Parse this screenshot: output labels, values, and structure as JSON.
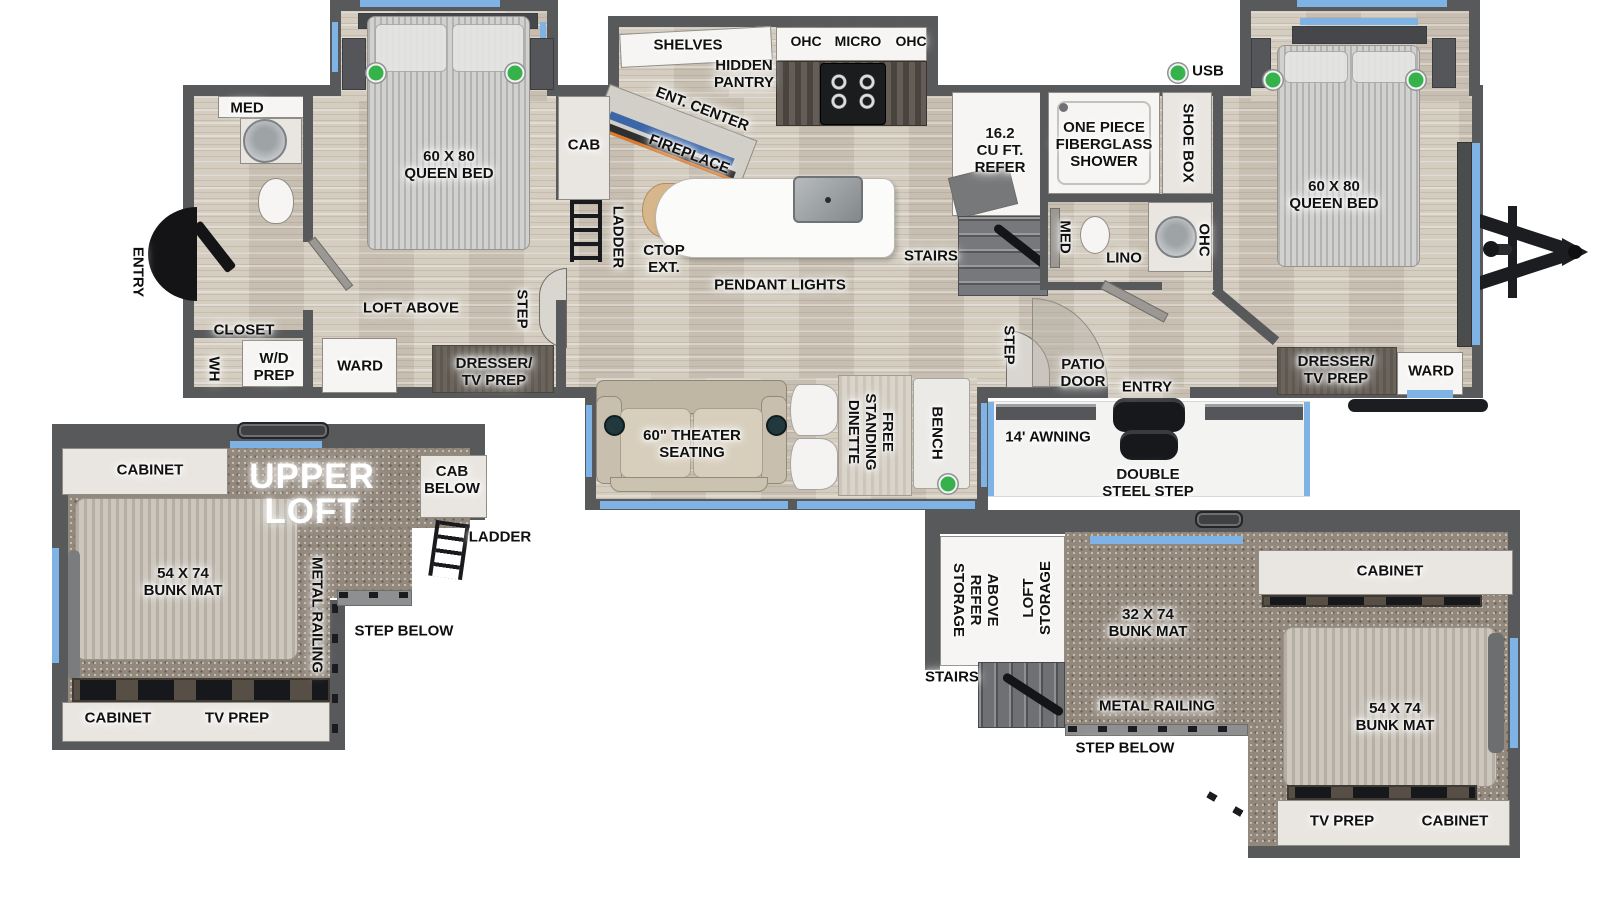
{
  "colors": {
    "wall": "#58595b",
    "floor_wood": "#cfc7b9",
    "carpet": "#93887c",
    "window_blue": "#7fb2e5",
    "usb_green": "#35b24a",
    "island_white": "#fbfbfa",
    "fireplace_orange": "#dd7a2c",
    "tv_blue": "#3b66a8",
    "steel_black": "#1c1d20"
  },
  "fp": {
    "main": {
      "rear": {
        "entry": "ENTRY",
        "med": "MED",
        "closet": "CLOSET",
        "wh": "WH",
        "wd": "W/D\nPREP"
      },
      "bed2": {
        "queen": "60 X 80\nQUEEN BED",
        "loft": "LOFT ABOVE",
        "ward": "WARD",
        "dresser": "DRESSER/\nTV PREP",
        "step": "STEP"
      },
      "kit": {
        "shelves": "SHELVES",
        "pantry": "HIDDEN\nPANTRY",
        "ent": "ENT. CENTER",
        "fire": "FIREPLACE",
        "cab": "CAB",
        "ladder": "LADDER",
        "ctop": "CTOP\nEXT.",
        "pendant": "PENDANT LIGHTS",
        "ohc1": "OHC",
        "micro": "MICRO",
        "ohc2": "OHC",
        "refer": "16.2\nCU FT.\nREFER",
        "stairs": "STAIRS",
        "step": "STEP"
      },
      "bath": {
        "shower": "ONE PIECE\nFIBERGLASS\nSHOWER",
        "shoe": "SHOE BOX",
        "med": "MED",
        "lino": "LINO",
        "ohc": "OHC"
      },
      "bed1": {
        "queen": "60 X 80\nQUEEN BED",
        "dresser": "DRESSER/\nTV PREP",
        "ward": "WARD"
      },
      "door": {
        "patio": "PATIO\nDOOR",
        "entry": "ENTRY"
      },
      "liv": {
        "theater": "60\" THEATER\nSEATING",
        "dinette": "FREE\nSTANDING\nDINETTE",
        "bench": "BENCH"
      },
      "ext": {
        "usb": "USB",
        "awning": "14' AWNING",
        "steps": "DOUBLE\nSTEEL STEP"
      }
    },
    "loft_rear": {
      "title": "UPPER\nLOFT",
      "cab_top": "CABINET",
      "cab_below": "CAB\nBELOW",
      "ladder": "LADDER",
      "bunk": "54 X 74\nBUNK MAT",
      "rail": "METAL RAILING",
      "step": "STEP BELOW",
      "cab_bot": "CABINET",
      "tv": "TV PREP"
    },
    "loft_front": {
      "refer_storage": "ABOVE\nREFER\nSTORAGE",
      "loft_storage": "LOFT\nSTORAGE",
      "stairs": "STAIRS",
      "bunk32": "32 X 74\nBUNK MAT",
      "cab_top": "CABINET",
      "bunk54": "54 X 74\nBUNK MAT",
      "rail": "METAL RAILING",
      "step": "STEP BELOW",
      "tv": "TV PREP",
      "cab_bot": "CABINET"
    }
  }
}
